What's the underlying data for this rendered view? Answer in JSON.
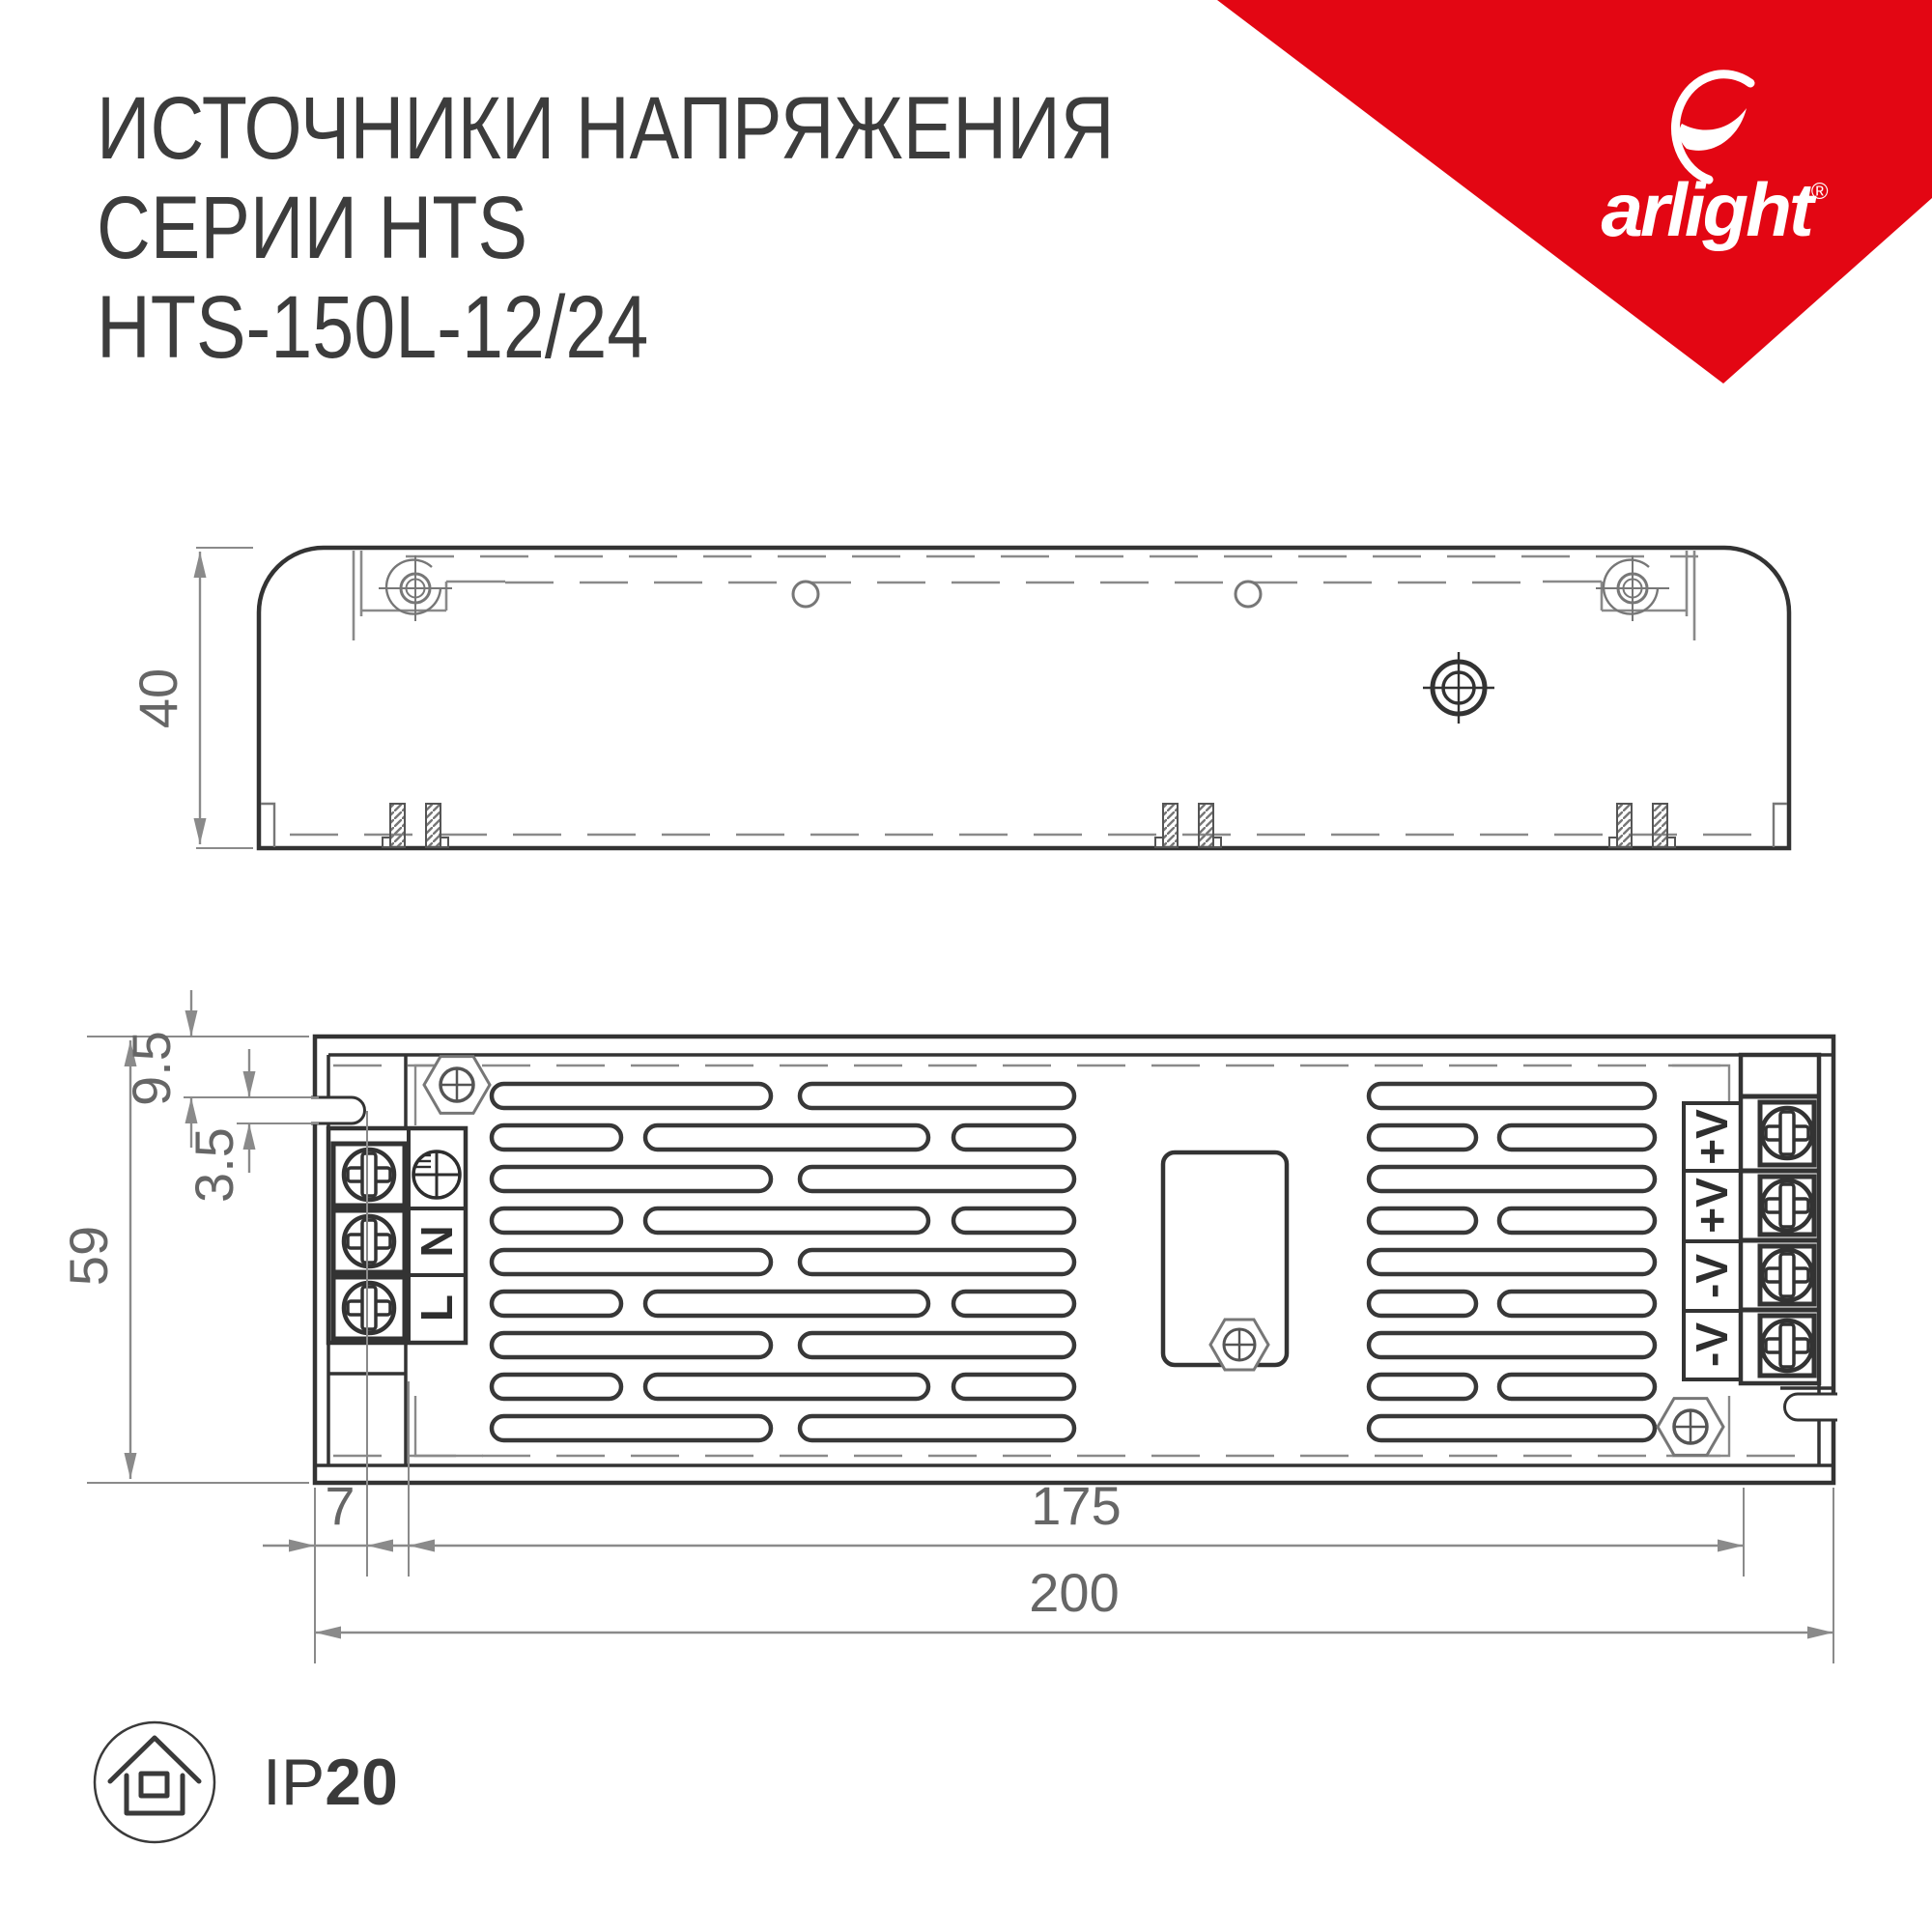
{
  "header": {
    "title_line1": "ИСТОЧНИКИ НАПРЯЖЕНИЯ",
    "title_line2": "СЕРИИ HTS",
    "title_line3": "HTS-150L-12/24"
  },
  "brand": {
    "logo_text": "arlight",
    "registered_mark": "®",
    "accent_color": "#E30613"
  },
  "side_view": {
    "dim_height": "40"
  },
  "plan_view": {
    "dim_total_height": "59",
    "dim_slot_offset": "9.5",
    "dim_slot_width": "3.5",
    "dim_flange_width": "7",
    "dim_mounting_length": "175",
    "dim_total_length": "200",
    "input_labels": {
      "neutral": "N",
      "line": "L"
    },
    "output_terminals": [
      "+V",
      "+V",
      "-V",
      "-V"
    ]
  },
  "ip_badge": {
    "prefix": "IP",
    "value": "20"
  }
}
